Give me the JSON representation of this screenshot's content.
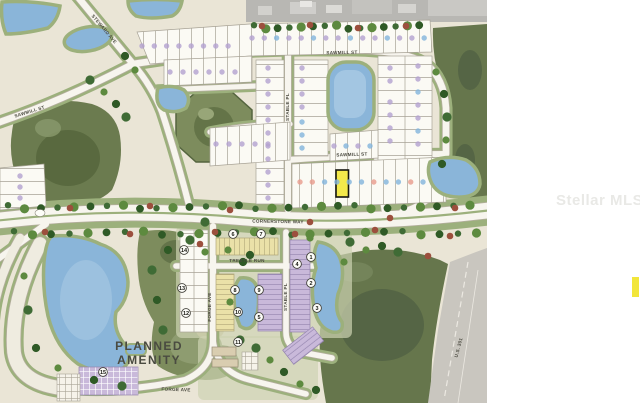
{
  "watermark": {
    "text": "Stellar MLS",
    "accent_color": "#f2e63a"
  },
  "map": {
    "street_labels": [
      {
        "text": "STEWARD AVE",
        "x": 103,
        "y": 30,
        "rotate": 50
      },
      {
        "text": "SAWMILL ST",
        "x": 30,
        "y": 113,
        "rotate": -17
      },
      {
        "text": "SAWMILL ST",
        "x": 342,
        "y": 54,
        "rotate": -1
      },
      {
        "text": "STABLE PL",
        "x": 289,
        "y": 107,
        "rotate": -90
      },
      {
        "text": "SAWMILL ST",
        "x": 352,
        "y": 156,
        "rotate": -2
      },
      {
        "text": "CORNERSTONE WAY",
        "x": 278,
        "y": 223,
        "rotate": 1
      },
      {
        "text": "TRESTLE RUN",
        "x": 247,
        "y": 262,
        "rotate": 0
      },
      {
        "text": "FORGE AVE",
        "x": 211,
        "y": 307,
        "rotate": -90
      },
      {
        "text": "STABLE PL",
        "x": 287,
        "y": 297,
        "rotate": -90
      },
      {
        "text": "FORGE AVE",
        "x": 176,
        "y": 391,
        "rotate": 2
      },
      {
        "text": "U.S. 301",
        "x": 460,
        "y": 348,
        "rotate": -75
      }
    ],
    "area_labels": [
      {
        "text": "PLANNED",
        "x": 149,
        "y": 350
      },
      {
        "text": "AMENITY",
        "x": 149,
        "y": 364
      }
    ],
    "parcel_markers": [
      {
        "label": "1",
        "x": 311,
        "y": 257
      },
      {
        "label": "2",
        "x": 311,
        "y": 283
      },
      {
        "label": "3",
        "x": 317,
        "y": 308
      },
      {
        "label": "4",
        "x": 297,
        "y": 264
      },
      {
        "label": "5",
        "x": 259,
        "y": 317
      },
      {
        "label": "6",
        "x": 233,
        "y": 234
      },
      {
        "label": "7",
        "x": 261,
        "y": 234
      },
      {
        "label": "8",
        "x": 235,
        "y": 290
      },
      {
        "label": "9",
        "x": 259,
        "y": 290
      },
      {
        "label": "10",
        "x": 238,
        "y": 312
      },
      {
        "label": "11",
        "x": 238,
        "y": 342
      },
      {
        "label": "12",
        "x": 186,
        "y": 313
      },
      {
        "label": "13",
        "x": 182,
        "y": 288
      },
      {
        "label": "14",
        "x": 184,
        "y": 250
      },
      {
        "label": "15",
        "x": 103,
        "y": 372
      }
    ],
    "highlighted_lot": {
      "x": 336,
      "y": 170,
      "width": 12.5,
      "height": 27,
      "fill": "#f3e94b"
    },
    "palette": {
      "base": "#eae5d6",
      "water": "#8ab5d9",
      "water_light": "#aecde6",
      "verge": "#9cb07c",
      "forest": "#66764c",
      "park": "#7d8c5d",
      "lot": "#fbfaf4",
      "road": "#f7f5ee",
      "highway_gray": "#c9c6bf",
      "aerial_gray": "#b8b7b3",
      "dot_lavender": "#b3a1cf",
      "dot_blue": "#82b4dc",
      "dot_salmon": "#e89b8c",
      "townhome_purple": "#c9b9da",
      "townhome_yellow": "#eae1a8"
    }
  }
}
